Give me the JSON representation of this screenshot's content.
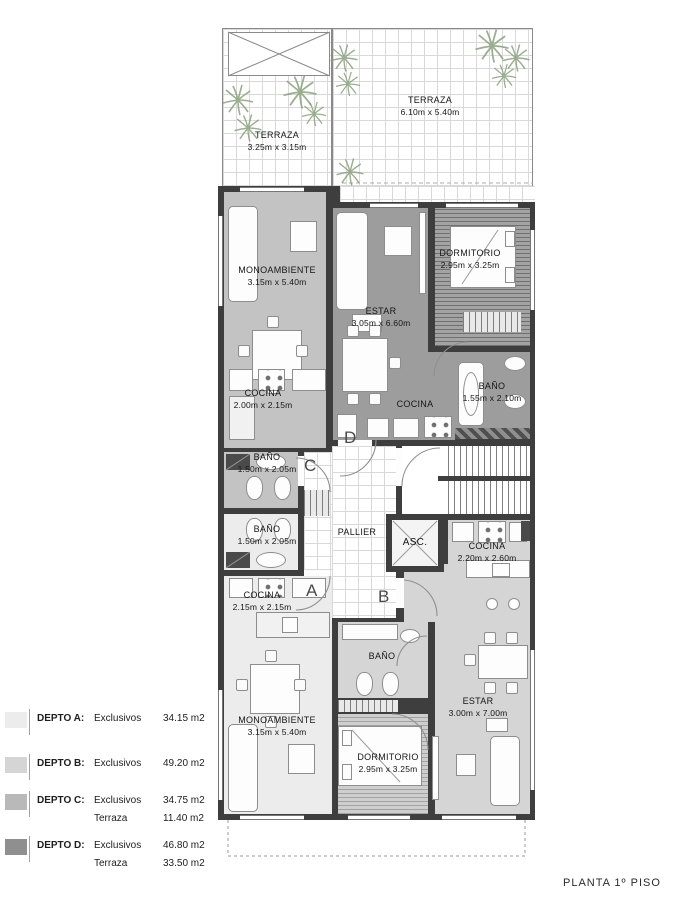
{
  "title": "PLANTA  1º PISO",
  "markers": {
    "a": "A",
    "b": "B",
    "c": "C",
    "d": "D"
  },
  "terraces": {
    "left": {
      "name": "TERRAZA",
      "dims": "3.25m x 3.15m"
    },
    "right": {
      "name": "TERRAZA",
      "dims": "6.10m x 5.40m"
    }
  },
  "rooms": {
    "mono_c": {
      "name": "MONOAMBIENTE",
      "dims": "3.15m x 5.40m"
    },
    "estar_d": {
      "name": "ESTAR",
      "dims": "3.05m x 6.60m"
    },
    "dorm_d": {
      "name": "DORMITORIO",
      "dims": "2.95m x 3.25m"
    },
    "cocina_c": {
      "name": "COCINA",
      "dims": "2.00m x 2.15m"
    },
    "bano_d": {
      "name": "BAÑO",
      "dims": "1.55m x 2.10m"
    },
    "cocina_d": {
      "name": "COCINA"
    },
    "bano_c": {
      "name": "BAÑO",
      "dims": "1.50m x 2.05m"
    },
    "bano_a": {
      "name": "BAÑO",
      "dims": "1.50m x 2.05m"
    },
    "pallier": {
      "name": "PALLIER"
    },
    "asc": {
      "name": "ASC."
    },
    "cocina_b": {
      "name": "COCINA",
      "dims": "2.20m x 2.60m"
    },
    "cocina_a": {
      "name": "COCINA",
      "dims": "2.15m x 2.15m"
    },
    "mono_a": {
      "name": "MONOAMBIENTE",
      "dims": "3.15m x 5.40m"
    },
    "bano_b": {
      "name": "BAÑO"
    },
    "dorm_b": {
      "name": "DORMITORIO",
      "dims": "2.95m x 3.25m"
    },
    "estar_b": {
      "name": "ESTAR",
      "dims": "3.00m x 7.00m"
    }
  },
  "legend": {
    "items": [
      {
        "name": "DEPTO A:",
        "color": "#ececec",
        "rows": [
          {
            "label": "Exclusivos",
            "value": "34.15 m2"
          }
        ]
      },
      {
        "name": "DEPTO B:",
        "color": "#d5d5d5",
        "rows": [
          {
            "label": "Exclusivos",
            "value": "49.20 m2"
          }
        ]
      },
      {
        "name": "DEPTO C:",
        "color": "#b9b9b9",
        "rows": [
          {
            "label": "Exclusivos",
            "value": "34.75 m2"
          },
          {
            "label": "Terraza",
            "value": "11.40 m2"
          }
        ]
      },
      {
        "name": "DEPTO D:",
        "color": "#8f8f8f",
        "rows": [
          {
            "label": "Exclusivos",
            "value": "46.80 m2"
          },
          {
            "label": "Terraza",
            "value": "33.50 m2"
          }
        ]
      }
    ]
  },
  "colors": {
    "wall": "#3e3e3e",
    "depto_a_floor": "#ececec",
    "depto_b_floor": "#d5d5d5",
    "depto_c_floor": "#c3c3c3",
    "depto_d_floor": "#9d9d9d",
    "plant": "#8ba07e"
  }
}
